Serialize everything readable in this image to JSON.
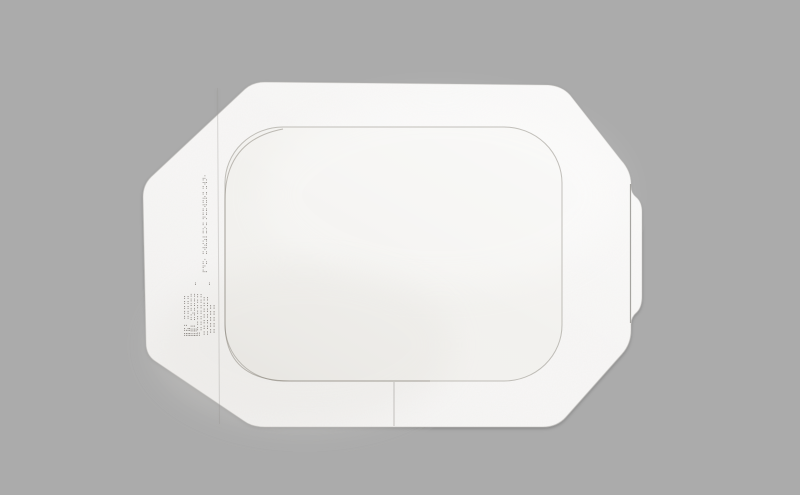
{
  "scene": {
    "description": "Photograph of a transparent film adhesive wound dressing with a white paper application frame, lying on a plain gray background",
    "object": "transparent-film-dressing",
    "colors": {
      "background": "#ababab",
      "frame": "#f7f6f5",
      "window": "#f2f1ee",
      "window_outline": "#948f87",
      "print": "#6b6560",
      "crease": "#9b9894"
    }
  },
  "print": {
    "size_line": "⠏⠙⠭⠂ ⠭⠺⠮⠵⠇⠭⠕⠭ ⠝⠭⠭⠺⠭⠗⠭ ⠭⠺⠝⠂",
    "mark_a": "⠒",
    "mark_b": "⠒",
    "logo_lines": [
      "⣿⣯⠃ ⠭⠭⠭⠭⠭",
      "⣿⣿⠇ ⠭⠵⠭⠭⠭⠭",
      "⠛⠭⠭⠭⠭⠭⠭⠭",
      "⠭⠭⠭⠭⠭⠭⠭",
      "⠭⠭⠭⠭⠭"
    ]
  }
}
